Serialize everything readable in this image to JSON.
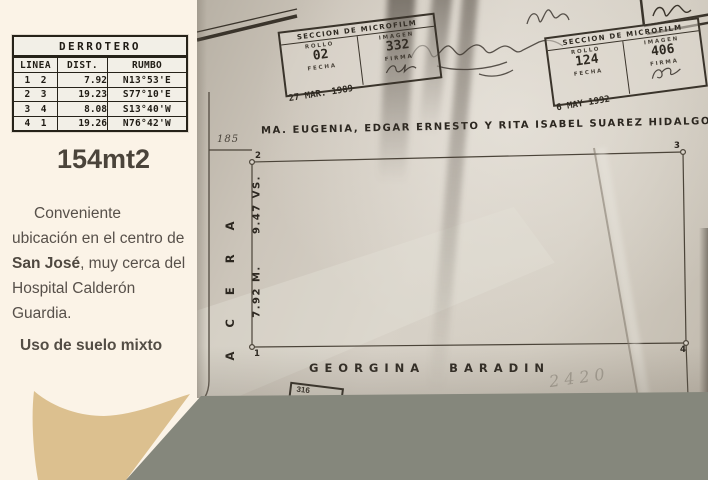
{
  "listing": {
    "area": "154mt2",
    "description": {
      "part1": "Conveniente ubicación en el centro de ",
      "bold": "San José",
      "part2": ", muy cerca del Hospital Calderón Guardia."
    },
    "usage": "Uso de suelo mixto"
  },
  "derrotero": {
    "title": "DERROTERO",
    "headers": {
      "linea": "LINEA",
      "dist": "DIST.",
      "rumbo": "RUMBO"
    },
    "rows": [
      {
        "from": "1",
        "to": "2",
        "dist": "7.92",
        "rumbo": "N13°53'E"
      },
      {
        "from": "2",
        "to": "3",
        "dist": "19.23",
        "rumbo": "S77°10'E"
      },
      {
        "from": "3",
        "to": "4",
        "dist": "8.08",
        "rumbo": "S13°40'W"
      },
      {
        "from": "4",
        "to": "1",
        "dist": "19.26",
        "rumbo": "N76°42'W"
      }
    ]
  },
  "survey": {
    "owner_top": "MA. EUGENIA, EDGAR ERNESTO Y RITA ISABEL SUAREZ HIDALGO",
    "neighbor_bottom": "GEORGINA BARADIN",
    "street": "ACERA",
    "front_dim": "185",
    "side_dim_vs": "9.47 VS.",
    "side_dim_m": "7.92 M.",
    "corners": {
      "c1": "1",
      "c2": "2",
      "c3": "3",
      "c4": "4"
    },
    "pencil_note": "2420",
    "mini_stamp": "316",
    "stamps": [
      {
        "title": "SECCION DE MICROFILM",
        "rollo_label": "ROLLO",
        "rollo": "02",
        "imagen_label": "IMAGEN",
        "imagen": "332",
        "fecha_label": "FECHA",
        "fecha": "27 MAR. 1989",
        "firma_label": "FIRMA"
      },
      {
        "title": "SECCION DE MICROFILM",
        "rollo_label": "ROLLO",
        "rollo": "124",
        "imagen_label": "IMAGEN",
        "imagen": "406",
        "fecha_label": "FECHA",
        "fecha": "6 MAY 1992",
        "firma_label": "FIRMA"
      }
    ]
  },
  "colors": {
    "cream": "#fbf3e7",
    "tan_accent": "#dcc08f",
    "gray_bar": "#85877c",
    "paper": "#d2ccc1",
    "ink": "#2c2720"
  }
}
